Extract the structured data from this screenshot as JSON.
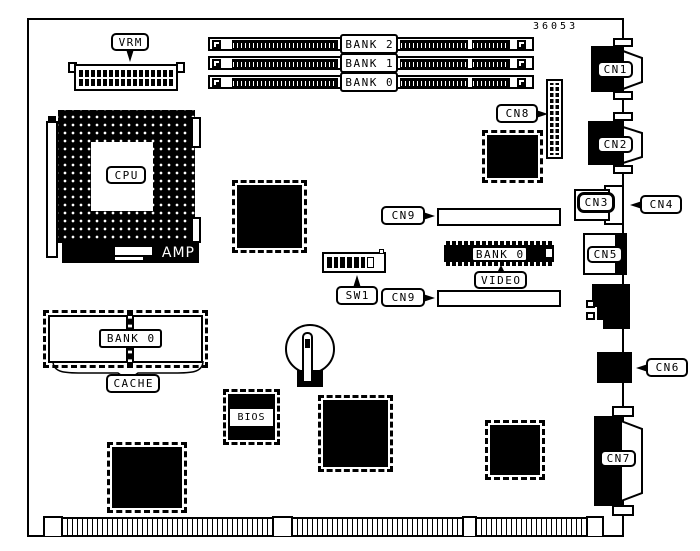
{
  "board": {
    "part_number": "36053"
  },
  "cpu": {
    "label": "CPU",
    "bracket": "AMP",
    "vrm": "VRM"
  },
  "memory": {
    "banks": [
      "BANK 2",
      "BANK 1",
      "BANK 0"
    ]
  },
  "video": {
    "bank": "BANK 0",
    "label": "VIDEO"
  },
  "cache": {
    "bank": "BANK 0",
    "label": "CACHE"
  },
  "bios": {
    "label": "BIOS"
  },
  "switch": {
    "label": "SW1"
  },
  "connectors": {
    "cn1": "CN1",
    "cn2": "CN2",
    "cn3": "CN3",
    "cn4": "CN4",
    "cn5": "CN5",
    "cn6": "CN6",
    "cn7": "CN7",
    "cn8": "CN8",
    "cn9_upper": "CN9",
    "cn9_lower": "CN9"
  }
}
